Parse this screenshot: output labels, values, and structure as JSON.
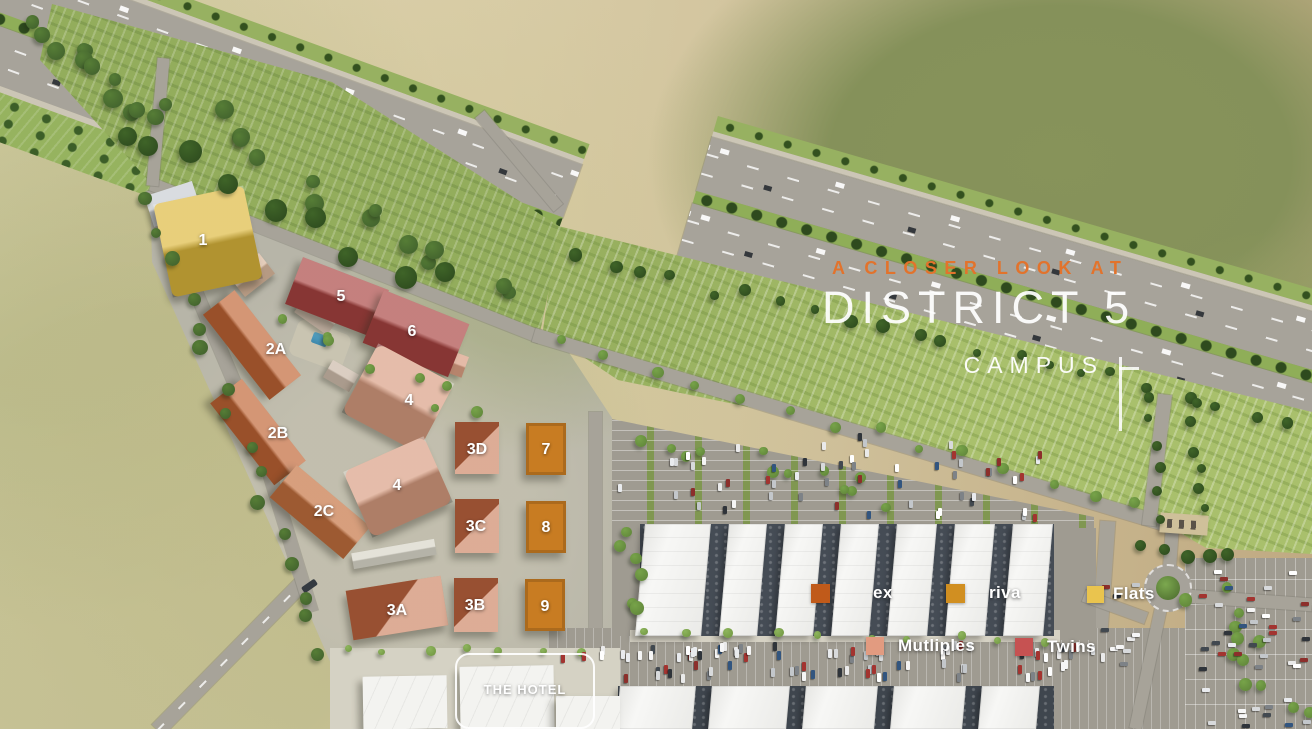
{
  "title": {
    "eyebrow": "A CLOSER LOOK AT",
    "main": "DISTRICT 5",
    "sub": "CAMPUS"
  },
  "legend": {
    "items": [
      {
        "label": "ex",
        "color": "#c05a1a"
      },
      {
        "label": "riva",
        "color": "#d18f21"
      },
      {
        "label": "Flats",
        "color": "#eac44e"
      },
      {
        "label": "Mutliples",
        "color": "#e29b80"
      },
      {
        "label": "Twins",
        "color": "#c65252"
      }
    ]
  },
  "hotel": {
    "label": "THE HOTEL"
  },
  "buildings": [
    {
      "label": "1",
      "color": "#ddb83c"
    },
    {
      "label": "5",
      "color": "#a94441"
    },
    {
      "label": "6",
      "color": "#a94441"
    },
    {
      "label": "2A",
      "color": "#bf6434"
    },
    {
      "label": "4",
      "color": "#d99d81"
    },
    {
      "label": "2B",
      "color": "#bf6434"
    },
    {
      "label": "2C",
      "color": "#c4713f"
    },
    {
      "label": "4",
      "color": "#d99d81"
    },
    {
      "label": "3D",
      "color": "#c4714a"
    },
    {
      "label": "7",
      "color": "#c87c22"
    },
    {
      "label": "3C",
      "color": "#c4714a"
    },
    {
      "label": "8",
      "color": "#c87c22"
    },
    {
      "label": "3A",
      "color": "#c4714a"
    },
    {
      "label": "3B",
      "color": "#c4714a"
    },
    {
      "label": "9",
      "color": "#c87c22"
    }
  ]
}
